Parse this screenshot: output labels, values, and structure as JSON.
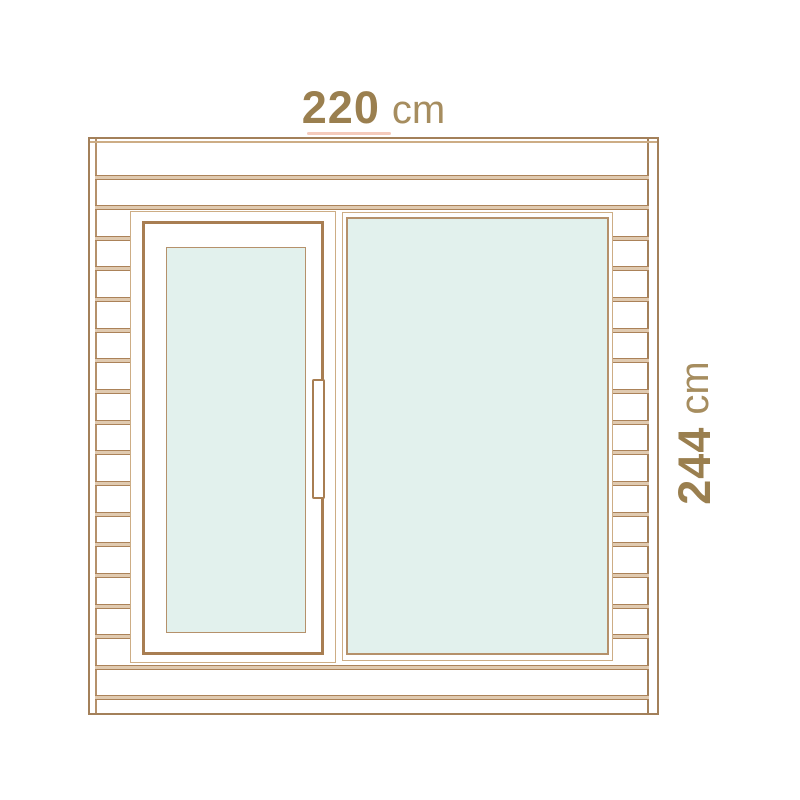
{
  "figure": {
    "type": "front-elevation-diagram",
    "subject": "cabin front with glazed door and fixed window"
  },
  "dimension_labels": {
    "width": {
      "value": "220",
      "unit": "cm"
    },
    "height": {
      "value": "244",
      "unit": "cm"
    }
  },
  "colors": {
    "background": "#ffffff",
    "outline_dark": "#a3805a",
    "outline_light": "#cdad85",
    "frame_thick": "#a87e52",
    "frame_mid": "#b5916b",
    "seam_fill": "#e0cab0",
    "seam_line": "#ab8259",
    "glass": "#e2f1ed",
    "value_text": "#9a7f4f",
    "unit_text": "#a68d5f",
    "accent": "#f5cbbc"
  },
  "structure": {
    "full_width_seams_y": [
      36,
      66,
      526,
      556
    ],
    "left_plank_seams": 14,
    "right_plank_seams": 14,
    "margin_seam_start_y": 66,
    "margin_seam_step": 30.67,
    "left_margin": {
      "x": 5,
      "width": 35
    },
    "right_margin": {
      "x": 523,
      "width": 36
    }
  }
}
